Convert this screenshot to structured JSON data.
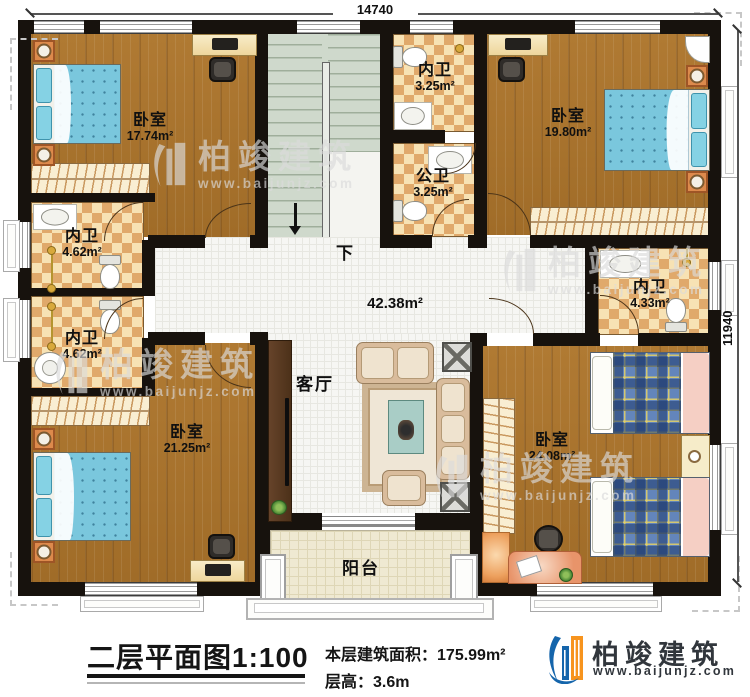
{
  "plan": {
    "dim_top": "14740",
    "dim_right": "11940",
    "stairs_down": "下",
    "hall_area": "42.38m²",
    "rooms": {
      "bedroom_tl": {
        "label": "卧室",
        "area": "17.74m²"
      },
      "bedroom_tr": {
        "label": "卧室",
        "area": "19.80m²"
      },
      "bedroom_bl": {
        "label": "卧室",
        "area": "21.25m²"
      },
      "bedroom_br": {
        "label": "卧室",
        "area": "24.08m²"
      },
      "bath_top": {
        "label": "内卫",
        "area": "3.25m²"
      },
      "bath_public": {
        "label": "公卫",
        "area": "3.25m²"
      },
      "bath_left_upper": {
        "label": "内卫",
        "area": "4.62m²"
      },
      "bath_left_lower": {
        "label": "内卫",
        "area": "4.62m²"
      },
      "bath_right": {
        "label": "内卫",
        "area": "4.33m²"
      },
      "living": {
        "label": "客厅"
      },
      "balcony": {
        "label": "阳台"
      }
    }
  },
  "title_block": {
    "plan_name": "二层平面图",
    "scale": "1:100",
    "area_label": "本层建筑面积：",
    "area_value": "175.99m²",
    "height_label": "层高：",
    "height_value": "3.6m"
  },
  "brand": {
    "name": "柏竣建筑",
    "website": "www.baijunjz.com"
  },
  "watermark": {
    "name": "柏竣建筑",
    "website": "www.baijunjz.com"
  },
  "colors": {
    "wall": "#17120d",
    "wood": "#aa7530",
    "checker_dark": "#e0a96b",
    "stairs": "#cfd9cc",
    "bed_blue": "#7ac7dd",
    "logo_blue": "#1565ab",
    "logo_orange": "#f7941e"
  }
}
